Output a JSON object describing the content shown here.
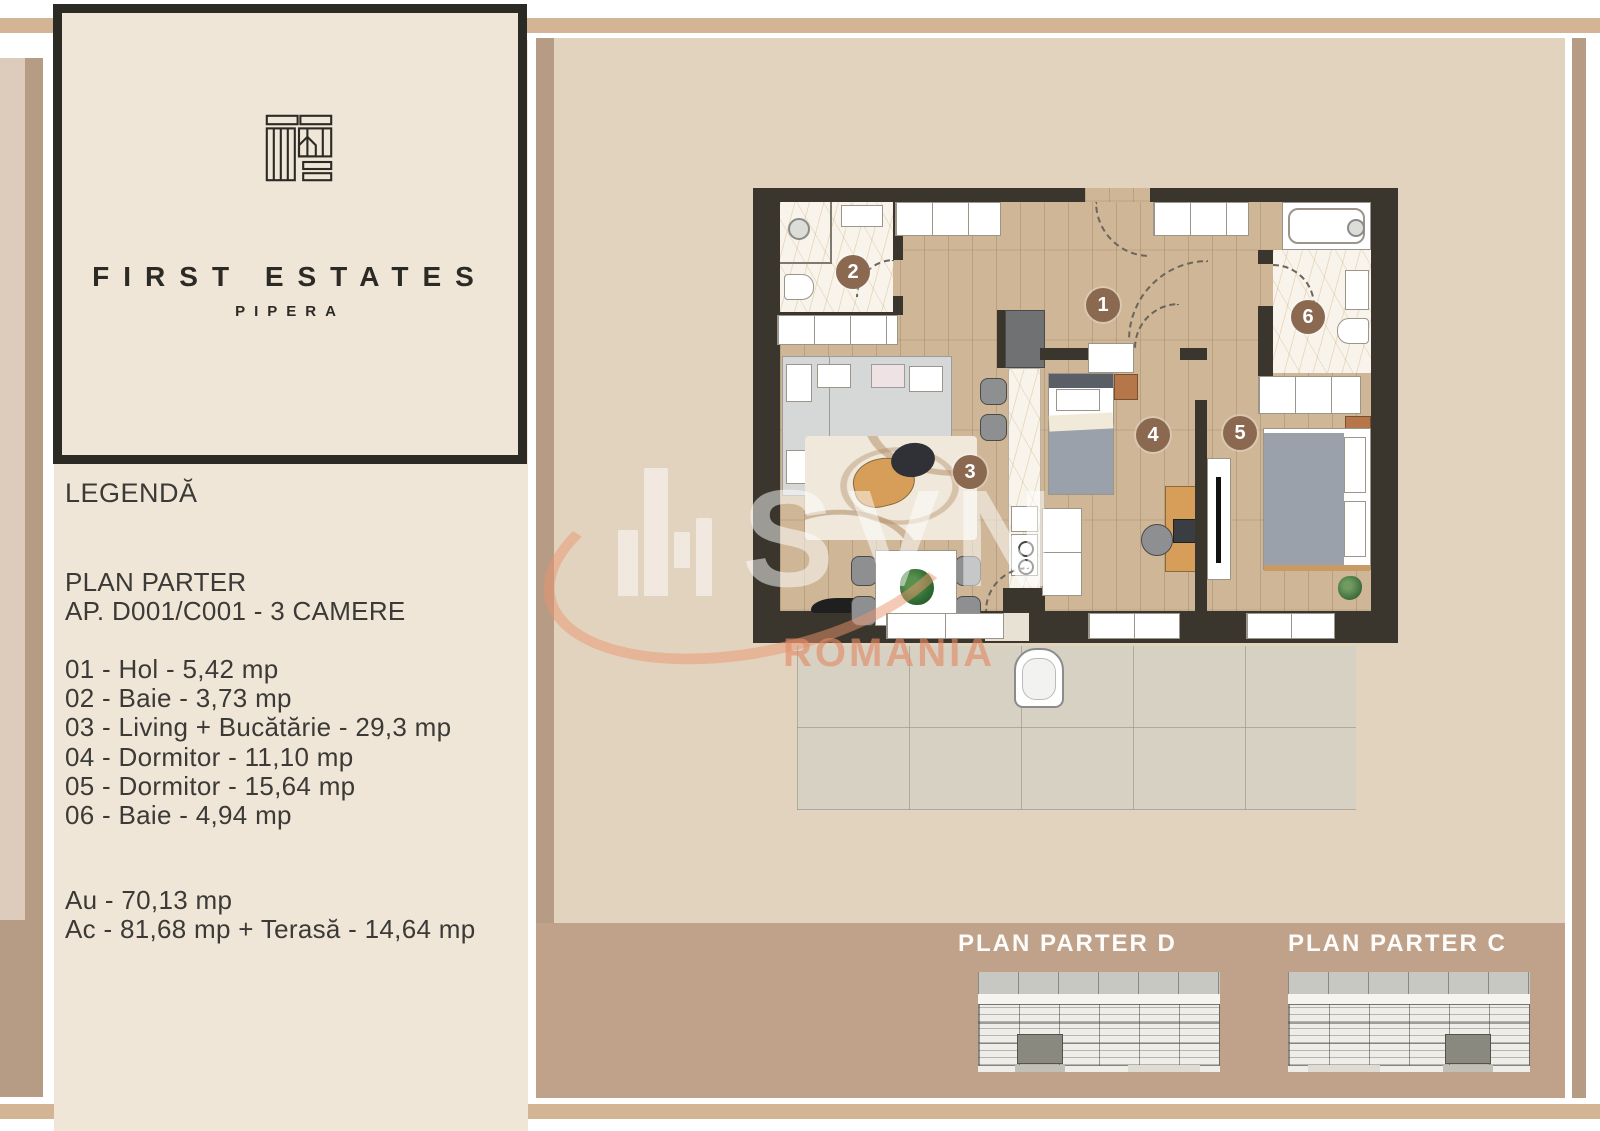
{
  "brand": {
    "name": "FIRST ESTATES",
    "subtitle": "PIPERA"
  },
  "legend": {
    "title": "LEGENDĂ",
    "plan_title": "PLAN PARTER",
    "apartment": "AP. D001/C001 - 3 CAMERE",
    "rooms": [
      {
        "id": "01",
        "name": "Hol",
        "area": "5,42 mp",
        "text": "01 - Hol - 5,42 mp"
      },
      {
        "id": "02",
        "name": "Baie",
        "area": "3,73 mp",
        "text": "02 - Baie - 3,73 mp"
      },
      {
        "id": "03",
        "name": "Living + Bucătărie",
        "area": "29,3 mp",
        "text": "03 - Living + Bucătărie - 29,3 mp"
      },
      {
        "id": "04",
        "name": "Dormitor",
        "area": "11,10 mp",
        "text": "04 - Dormitor - 11,10 mp"
      },
      {
        "id": "05",
        "name": "Dormitor",
        "area": "15,64 mp",
        "text": "05 - Dormitor - 15,64 mp"
      },
      {
        "id": "06",
        "name": "Baie",
        "area": "4,94 mp",
        "text": "06 - Baie - 4,94 mp"
      }
    ],
    "totals": [
      {
        "text": "Au - 70,13 mp"
      },
      {
        "text": "Ac - 81,68 mp + Terasă - 14,64 mp"
      }
    ]
  },
  "floorplan": {
    "room_markers": [
      "1",
      "2",
      "3",
      "4",
      "5",
      "6"
    ]
  },
  "watermark": {
    "brand": "SVN",
    "country": "ROMANIA"
  },
  "miniplans": [
    {
      "title": "PLAN PARTER D"
    },
    {
      "title": "PLAN PARTER C"
    }
  ],
  "colors": {
    "cream": "#f0e6d8",
    "band_tan": "#d3b595",
    "stripe_dark_tan": "#b69b85",
    "stripe_light_beige": "#ddccbb",
    "panel_fill": "#e2d3bf",
    "panel_footer": "#bfa289",
    "wall": "#3b362d",
    "wood_floor": "#ceb697",
    "room_marker": "#8a6950",
    "logo_ink": "#2b2a25",
    "watermark_salmon": "#e28c68"
  }
}
